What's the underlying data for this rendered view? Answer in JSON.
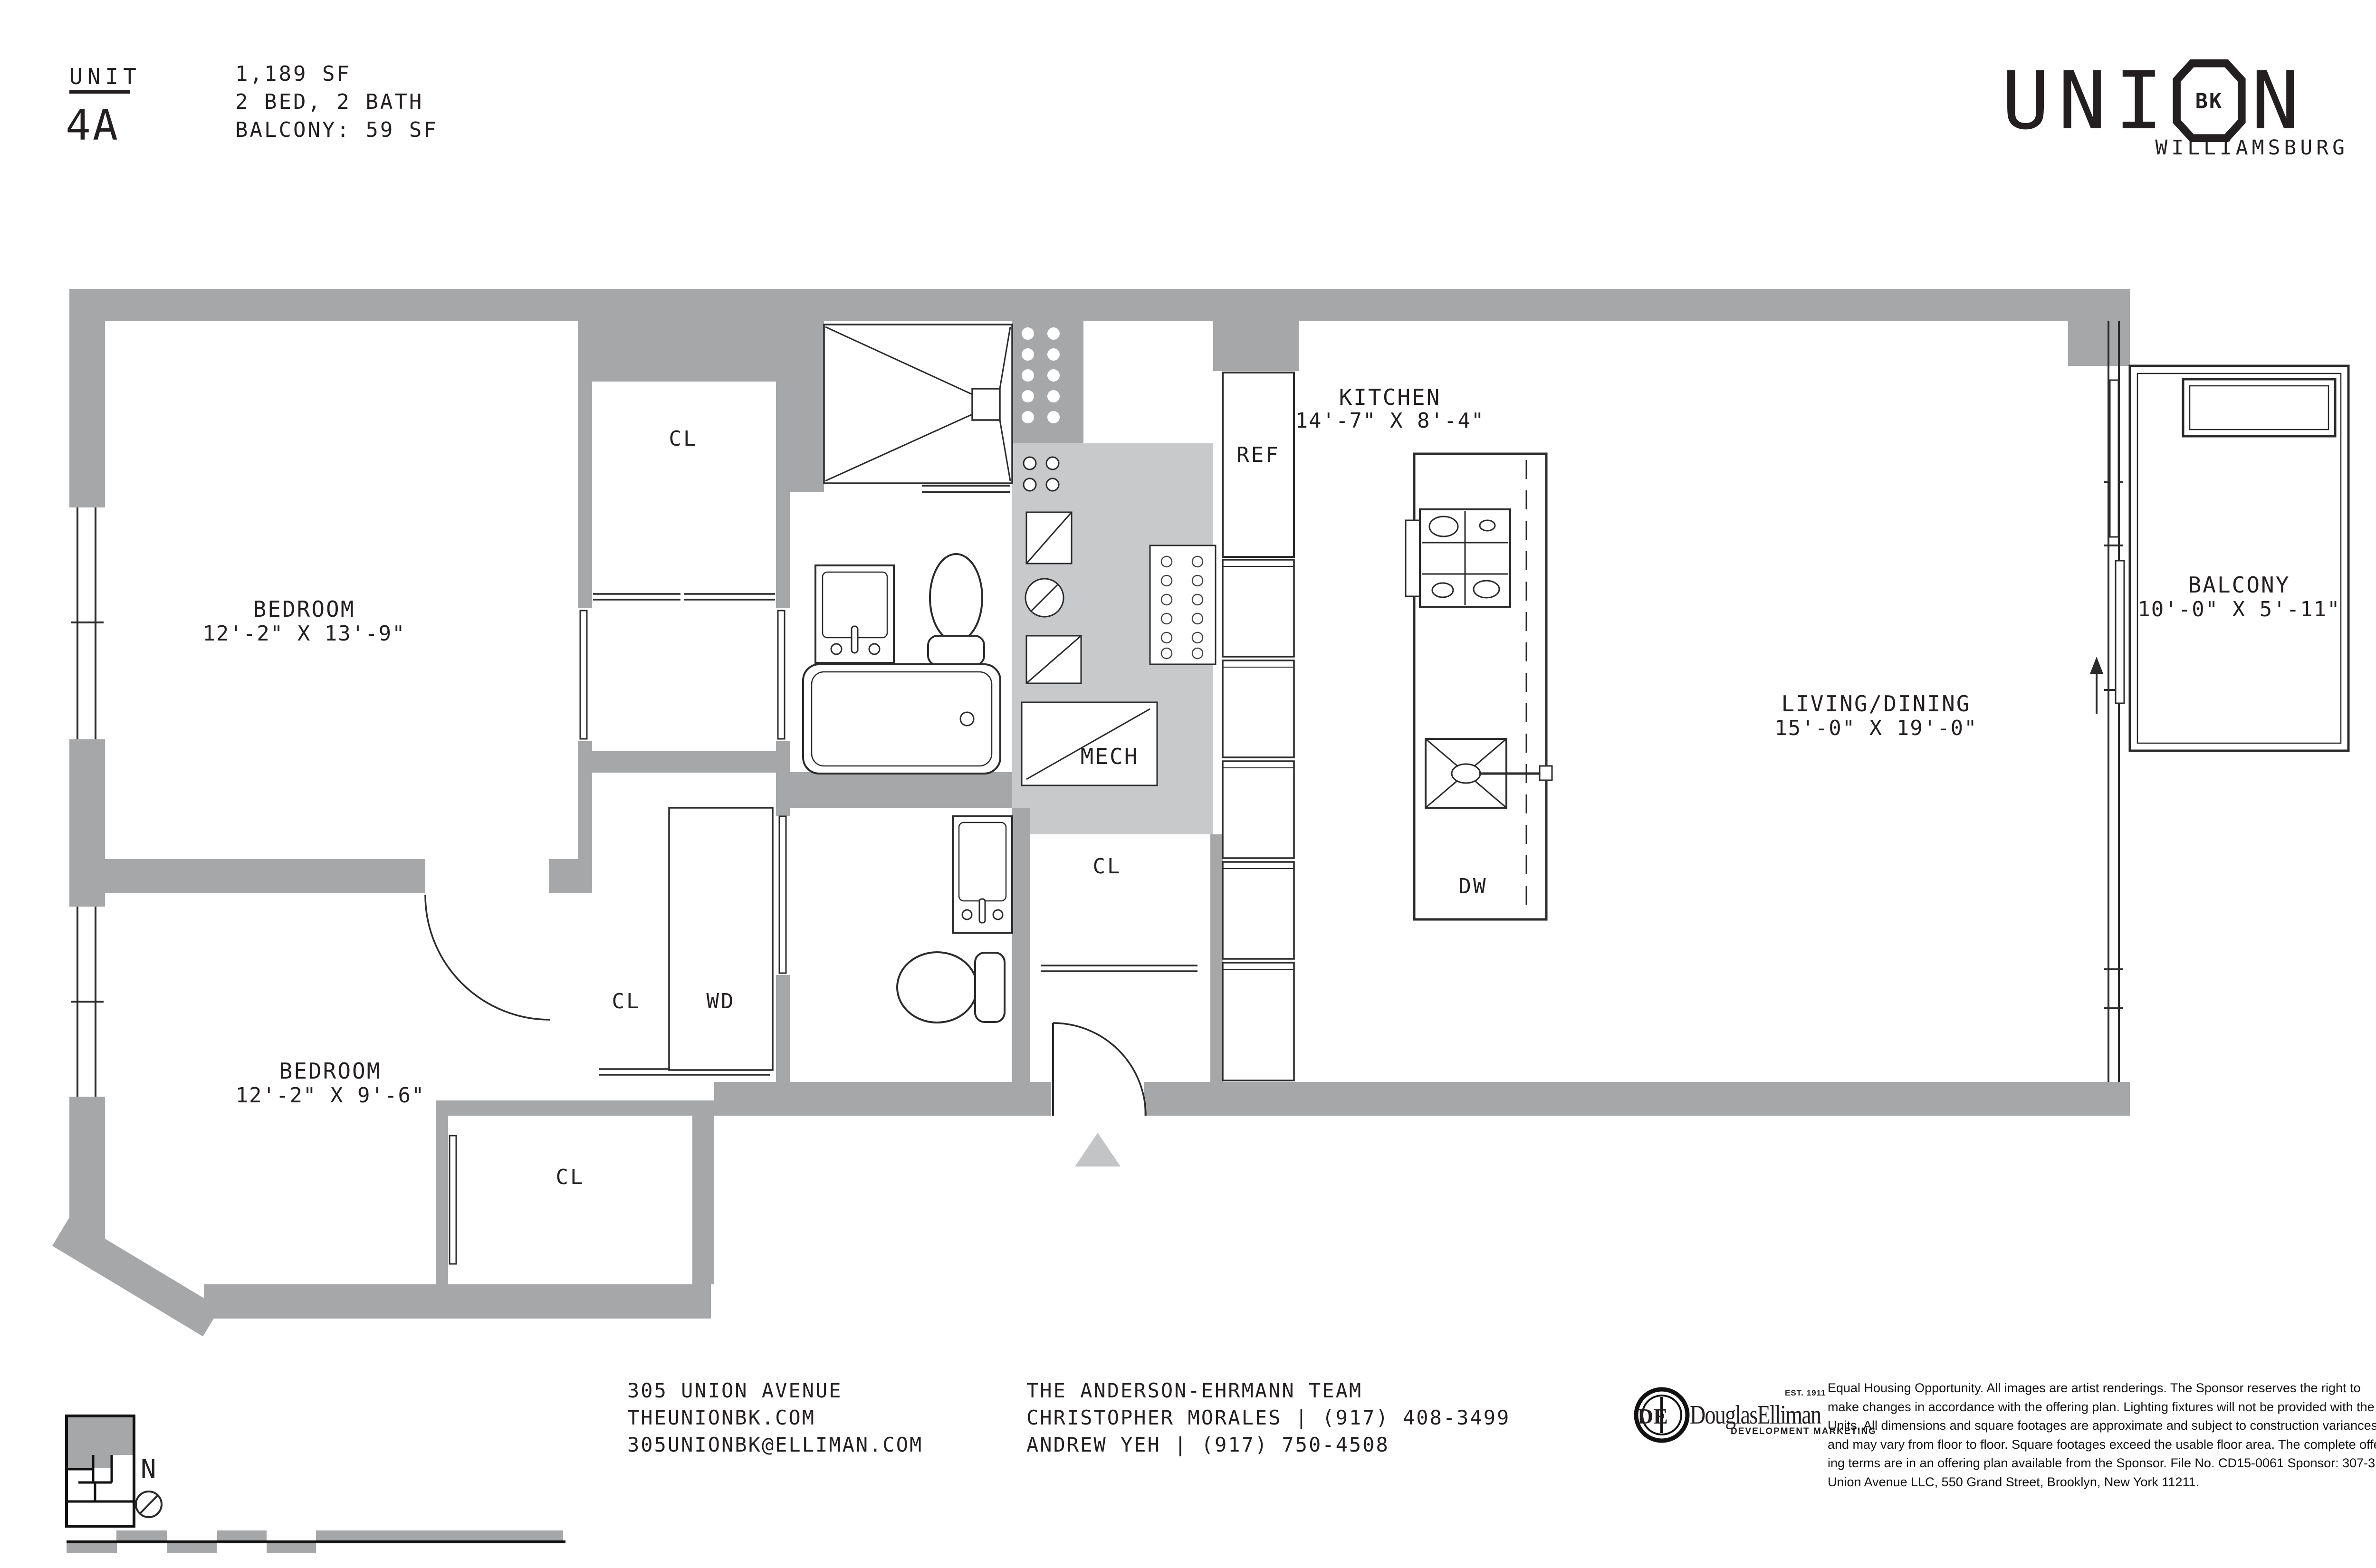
{
  "header": {
    "unit_label": "UNIT",
    "unit_number": "4A",
    "stats": [
      "1,189 SF",
      "2 BED, 2 BATH",
      "BALCONY: 59 SF"
    ]
  },
  "brand": {
    "letter_u": "U",
    "letter_n1": "N",
    "letter_i": "I",
    "octagon_text": "BK",
    "letter_n2": "N",
    "subtitle": "WILLIAMSBURG"
  },
  "plan": {
    "bedroom_1": {
      "name": "BEDROOM",
      "dims": "12'-2\" X 13'-9\""
    },
    "bedroom_2": {
      "name": "BEDROOM",
      "dims": "12'-2\" X 9'-6\""
    },
    "kitchen": {
      "name": "KITCHEN",
      "dims": "14'-7\" X 8'-4\""
    },
    "living_dining": {
      "name": "LIVING/DINING",
      "dims": "15'-0\" X 19'-0\""
    },
    "balcony": {
      "name": "BALCONY",
      "dims": "10'-0\" X 5'-11\""
    },
    "mech": "MECH",
    "closet": "CL",
    "washer_dryer": "WD",
    "refrigerator": "REF",
    "dishwasher": "DW",
    "north": "N"
  },
  "footer": {
    "address_lines": [
      "305 UNION AVENUE",
      "THEUNIONBK.COM",
      "305UNIONBK@ELLIMAN.COM"
    ],
    "team_lines": [
      "THE ANDERSON-EHRMANN TEAM",
      "CHRISTOPHER MORALES | (917) 408-3499",
      "ANDREW YEH | (917) 750-4508"
    ],
    "elliman": {
      "monogram": "DE",
      "name": "DouglasElliman",
      "est": "EST. 1911",
      "division": "DEVELOPMENT MARKETING"
    },
    "legal_lines": [
      "Equal Housing Opportunity. All images are artist renderings. The Sponsor reserves the right to",
      "make changes in accordance with the offering plan. Lighting fixtures will not be provided with the",
      "Units. All dimensions and square footages are approximate and subject to construction variances",
      "and may vary from floor to floor. Square footages exceed the usable floor area. The complete offer-",
      "ing terms are in an offering plan available from the Sponsor. File No. CD15-0061 Sponsor: 307-311",
      "Union Avenue LLC, 550 Grand Street, Brooklyn, New York 11211."
    ]
  },
  "colors": {
    "wall": "#a6a7a9",
    "mech_fill": "#c8c9cb",
    "line": "#2b2b2b",
    "text": "#231f20",
    "entry_arrow": "#c3c4c6"
  }
}
